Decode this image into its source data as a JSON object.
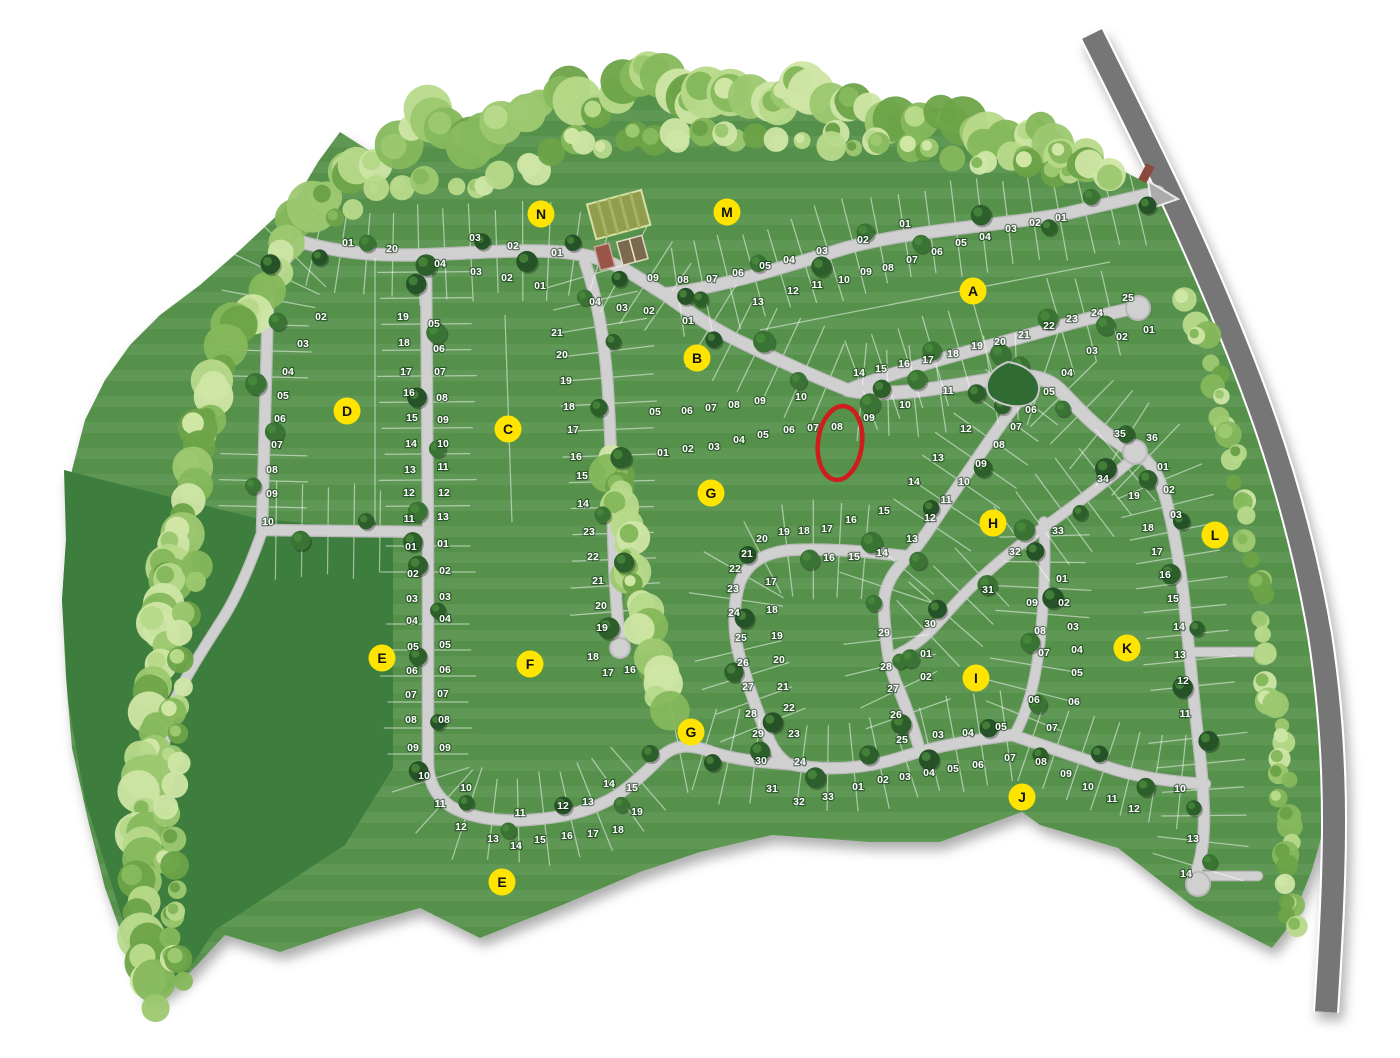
{
  "map_type": "residential-subdivision-lot-plan",
  "palette": {
    "lot_green": "#55914b",
    "open_space_green": "#3e7d3c",
    "road_light": "#d0d0d0",
    "road_dark": "#767676",
    "badge_yellow": "#ffe400",
    "highlight_red": "#cf1d1d",
    "tree_dark": "#2d5f2b",
    "tree_light": "#b7d98a"
  },
  "highlight": {
    "lot": "08",
    "x": 840,
    "y": 443,
    "rx": 22,
    "ry": 37,
    "color": "#cf1d1d"
  },
  "badges": [
    {
      "letter": "A",
      "x": 973,
      "y": 291
    },
    {
      "letter": "B",
      "x": 697,
      "y": 358
    },
    {
      "letter": "C",
      "x": 508,
      "y": 429
    },
    {
      "letter": "D",
      "x": 347,
      "y": 411
    },
    {
      "letter": "E",
      "x": 382,
      "y": 658
    },
    {
      "letter": "E",
      "x": 502,
      "y": 882
    },
    {
      "letter": "F",
      "x": 530,
      "y": 664
    },
    {
      "letter": "G",
      "x": 711,
      "y": 493
    },
    {
      "letter": "G",
      "x": 691,
      "y": 732
    },
    {
      "letter": "H",
      "x": 993,
      "y": 523
    },
    {
      "letter": "I",
      "x": 976,
      "y": 678
    },
    {
      "letter": "J",
      "x": 1022,
      "y": 797
    },
    {
      "letter": "K",
      "x": 1127,
      "y": 648
    },
    {
      "letter": "L",
      "x": 1215,
      "y": 535
    },
    {
      "letter": "M",
      "x": 727,
      "y": 212
    },
    {
      "letter": "N",
      "x": 541,
      "y": 214
    }
  ],
  "sections": [
    {
      "id": "D",
      "lots": [
        [
          "01",
          348,
          242
        ],
        [
          "02",
          321,
          316
        ],
        [
          "03",
          303,
          343
        ],
        [
          "04",
          288,
          371
        ],
        [
          "05",
          283,
          395
        ],
        [
          "06",
          280,
          418
        ],
        [
          "07",
          277,
          444
        ],
        [
          "08",
          272,
          469
        ],
        [
          "09",
          272,
          493
        ],
        [
          "10",
          268,
          521
        ],
        [
          "20",
          392,
          248
        ],
        [
          "19",
          403,
          316
        ],
        [
          "18",
          404,
          342
        ],
        [
          "17",
          406,
          371
        ],
        [
          "16",
          409,
          392
        ],
        [
          "15",
          412,
          417
        ],
        [
          "14",
          411,
          443
        ],
        [
          "13",
          410,
          469
        ],
        [
          "12",
          409,
          492
        ],
        [
          "11",
          409,
          518
        ]
      ]
    },
    {
      "id": "N",
      "lots": [
        [
          "03",
          475,
          237
        ],
        [
          "02",
          513,
          245
        ],
        [
          "01",
          557,
          252
        ],
        [
          "04",
          440,
          263
        ],
        [
          "03",
          476,
          271
        ],
        [
          "02",
          507,
          277
        ],
        [
          "01",
          540,
          285
        ]
      ]
    },
    {
      "id": "C",
      "lots": [
        [
          "05",
          434,
          323
        ],
        [
          "06",
          439,
          348
        ],
        [
          "07",
          440,
          371
        ],
        [
          "08",
          442,
          397
        ],
        [
          "09",
          443,
          419
        ],
        [
          "10",
          443,
          443
        ],
        [
          "11",
          443,
          466
        ],
        [
          "12",
          444,
          492
        ],
        [
          "13",
          443,
          516
        ],
        [
          "21",
          557,
          332
        ],
        [
          "20",
          562,
          354
        ],
        [
          "19",
          566,
          380
        ],
        [
          "18",
          569,
          406
        ],
        [
          "17",
          573,
          429
        ],
        [
          "16",
          576,
          456
        ],
        [
          "15",
          582,
          475
        ],
        [
          "14",
          583,
          503
        ]
      ]
    },
    {
      "id": "M",
      "lots": [
        [
          "09",
          653,
          277
        ],
        [
          "08",
          683,
          279
        ],
        [
          "07",
          712,
          278
        ],
        [
          "06",
          738,
          272
        ],
        [
          "05",
          765,
          265
        ],
        [
          "04",
          789,
          259
        ],
        [
          "03",
          822,
          250
        ],
        [
          "02",
          863,
          239
        ],
        [
          "01",
          905,
          223
        ]
      ]
    },
    {
      "id": "A",
      "lots": [
        [
          "13",
          758,
          301
        ],
        [
          "12",
          793,
          290
        ],
        [
          "11",
          817,
          284
        ],
        [
          "10",
          844,
          279
        ],
        [
          "09",
          866,
          271
        ],
        [
          "08",
          888,
          267
        ],
        [
          "07",
          912,
          259
        ],
        [
          "06",
          937,
          251
        ],
        [
          "05",
          961,
          242
        ],
        [
          "04",
          985,
          236
        ],
        [
          "03",
          1011,
          228
        ],
        [
          "02",
          1035,
          222
        ],
        [
          "01",
          1061,
          217
        ],
        [
          "14",
          859,
          372
        ],
        [
          "15",
          881,
          368
        ],
        [
          "16",
          904,
          363
        ],
        [
          "17",
          928,
          359
        ],
        [
          "18",
          953,
          353
        ],
        [
          "19",
          977,
          345
        ],
        [
          "20",
          1000,
          341
        ],
        [
          "21",
          1024,
          334
        ],
        [
          "22",
          1049,
          325
        ],
        [
          "23",
          1072,
          318
        ],
        [
          "24",
          1097,
          312
        ],
        [
          "25",
          1128,
          297
        ]
      ]
    },
    {
      "id": "B",
      "lots": [
        [
          "04",
          595,
          301
        ],
        [
          "03",
          622,
          307
        ],
        [
          "02",
          649,
          310
        ],
        [
          "01",
          688,
          320
        ],
        [
          "05",
          655,
          411
        ],
        [
          "06",
          687,
          410
        ],
        [
          "07",
          711,
          407
        ],
        [
          "08",
          734,
          404
        ],
        [
          "09",
          760,
          400
        ],
        [
          "10",
          801,
          396
        ]
      ]
    },
    {
      "id": "G-upper",
      "lots": [
        [
          "01",
          663,
          452
        ],
        [
          "02",
          688,
          448
        ],
        [
          "03",
          714,
          446
        ],
        [
          "04",
          739,
          439
        ],
        [
          "05",
          763,
          434
        ],
        [
          "06",
          789,
          429
        ],
        [
          "07",
          813,
          427
        ],
        [
          "08",
          837,
          426
        ]
      ]
    },
    {
      "id": "H-col",
      "lots": [
        [
          "01",
          1149,
          329
        ],
        [
          "02",
          1122,
          336
        ],
        [
          "03",
          1092,
          350
        ],
        [
          "04",
          1067,
          372
        ],
        [
          "05",
          1049,
          391
        ],
        [
          "06",
          1031,
          409
        ],
        [
          "07",
          1016,
          426
        ],
        [
          "08",
          999,
          444
        ],
        [
          "09",
          981,
          463
        ],
        [
          "10",
          964,
          481
        ],
        [
          "11",
          946,
          499
        ],
        [
          "12",
          930,
          517
        ],
        [
          "13",
          912,
          538
        ],
        [
          "12",
          966,
          428
        ],
        [
          "13",
          938,
          457
        ],
        [
          "14",
          914,
          481
        ],
        [
          "09",
          869,
          417
        ],
        [
          "10",
          905,
          404
        ],
        [
          "11",
          948,
          390
        ]
      ]
    },
    {
      "id": "G",
      "lots": [
        [
          "19",
          784,
          531
        ],
        [
          "18",
          804,
          530
        ],
        [
          "17",
          827,
          528
        ],
        [
          "16",
          851,
          519
        ],
        [
          "15",
          884,
          510
        ],
        [
          "20",
          762,
          538
        ],
        [
          "21",
          747,
          553
        ],
        [
          "22",
          735,
          568
        ],
        [
          "23",
          733,
          588
        ],
        [
          "24",
          734,
          612
        ],
        [
          "25",
          741,
          637
        ],
        [
          "26",
          743,
          662
        ],
        [
          "27",
          748,
          686
        ],
        [
          "28",
          751,
          713
        ],
        [
          "29",
          758,
          733
        ],
        [
          "30",
          761,
          760
        ],
        [
          "31",
          772,
          788
        ],
        [
          "32",
          799,
          801
        ],
        [
          "33",
          828,
          796
        ],
        [
          "16",
          829,
          557
        ],
        [
          "15",
          854,
          556
        ],
        [
          "14",
          882,
          552
        ],
        [
          "17",
          771,
          581
        ],
        [
          "18",
          772,
          609
        ],
        [
          "19",
          777,
          635
        ],
        [
          "20",
          779,
          659
        ],
        [
          "21",
          783,
          686
        ],
        [
          "22",
          789,
          707
        ],
        [
          "23",
          794,
          733
        ],
        [
          "24",
          800,
          761
        ],
        [
          "25",
          902,
          739
        ],
        [
          "26",
          896,
          714
        ],
        [
          "27",
          893,
          688
        ],
        [
          "28",
          886,
          666
        ],
        [
          "29",
          884,
          632
        ],
        [
          "30",
          930,
          623
        ]
      ]
    },
    {
      "id": "H-ridge",
      "lots": [
        [
          "31",
          988,
          589
        ],
        [
          "32",
          1015,
          551
        ],
        [
          "33",
          1058,
          530
        ],
        [
          "34",
          1103,
          478
        ],
        [
          "35",
          1120,
          433
        ],
        [
          "36",
          1152,
          437
        ]
      ]
    },
    {
      "id": "I",
      "lots": [
        [
          "01",
          926,
          653
        ],
        [
          "02",
          926,
          676
        ],
        [
          "03",
          938,
          734
        ],
        [
          "04",
          968,
          732
        ],
        [
          "05",
          1001,
          726
        ],
        [
          "06",
          1034,
          699
        ],
        [
          "07",
          1044,
          652
        ],
        [
          "08",
          1040,
          630
        ],
        [
          "09",
          1032,
          602
        ]
      ]
    },
    {
      "id": "K",
      "lots": [
        [
          "01",
          1062,
          578
        ],
        [
          "02",
          1064,
          602
        ],
        [
          "03",
          1073,
          626
        ],
        [
          "04",
          1077,
          649
        ],
        [
          "05",
          1077,
          672
        ],
        [
          "06",
          1074,
          701
        ],
        [
          "07",
          1052,
          727
        ],
        [
          "19",
          1134,
          495
        ],
        [
          "18",
          1148,
          527
        ],
        [
          "17",
          1157,
          551
        ],
        [
          "16",
          1165,
          574
        ],
        [
          "15",
          1173,
          598
        ],
        [
          "14",
          1179,
          626
        ],
        [
          "13",
          1180,
          654
        ],
        [
          "12",
          1183,
          680
        ],
        [
          "11",
          1185,
          713
        ],
        [
          "10",
          1180,
          788
        ],
        [
          "13",
          1193,
          838
        ],
        [
          "14",
          1186,
          873
        ]
      ]
    },
    {
      "id": "L",
      "lots": [
        [
          "01",
          1163,
          466
        ],
        [
          "02",
          1169,
          489
        ],
        [
          "03",
          1176,
          514
        ]
      ]
    },
    {
      "id": "J",
      "lots": [
        [
          "01",
          858,
          786
        ],
        [
          "02",
          883,
          779
        ],
        [
          "03",
          905,
          776
        ],
        [
          "04",
          929,
          772
        ],
        [
          "05",
          953,
          768
        ],
        [
          "06",
          978,
          764
        ],
        [
          "07",
          1010,
          757
        ],
        [
          "08",
          1041,
          761
        ],
        [
          "09",
          1066,
          773
        ],
        [
          "10",
          1088,
          786
        ],
        [
          "11",
          1112,
          798
        ],
        [
          "12",
          1134,
          808
        ]
      ]
    },
    {
      "id": "E",
      "lots": [
        [
          "01",
          411,
          546
        ],
        [
          "02",
          413,
          573
        ],
        [
          "03",
          412,
          598
        ],
        [
          "04",
          412,
          620
        ],
        [
          "05",
          413,
          646
        ],
        [
          "06",
          412,
          670
        ],
        [
          "07",
          411,
          694
        ],
        [
          "08",
          411,
          719
        ],
        [
          "09",
          413,
          747
        ],
        [
          "10",
          424,
          775
        ],
        [
          "11",
          440,
          803
        ],
        [
          "12",
          461,
          826
        ],
        [
          "13",
          493,
          838
        ],
        [
          "14",
          516,
          845
        ]
      ]
    },
    {
      "id": "F",
      "lots": [
        [
          "01",
          443,
          543
        ],
        [
          "02",
          445,
          570
        ],
        [
          "03",
          445,
          596
        ],
        [
          "04",
          445,
          618
        ],
        [
          "05",
          445,
          644
        ],
        [
          "06",
          445,
          669
        ],
        [
          "07",
          443,
          693
        ],
        [
          "08",
          444,
          719
        ],
        [
          "09",
          445,
          747
        ],
        [
          "10",
          466,
          787
        ],
        [
          "11",
          520,
          812
        ],
        [
          "12",
          563,
          805
        ],
        [
          "13",
          588,
          801
        ],
        [
          "14",
          609,
          783
        ],
        [
          "15",
          632,
          787
        ],
        [
          "15",
          540,
          839
        ],
        [
          "16",
          567,
          835
        ],
        [
          "17",
          593,
          833
        ],
        [
          "18",
          618,
          829
        ],
        [
          "19",
          637,
          811
        ],
        [
          "23",
          589,
          531
        ],
        [
          "22",
          593,
          556
        ],
        [
          "21",
          598,
          580
        ],
        [
          "20",
          601,
          605
        ],
        [
          "19",
          602,
          627
        ],
        [
          "18",
          593,
          656
        ],
        [
          "17",
          608,
          672
        ],
        [
          "16",
          630,
          669
        ]
      ]
    }
  ]
}
